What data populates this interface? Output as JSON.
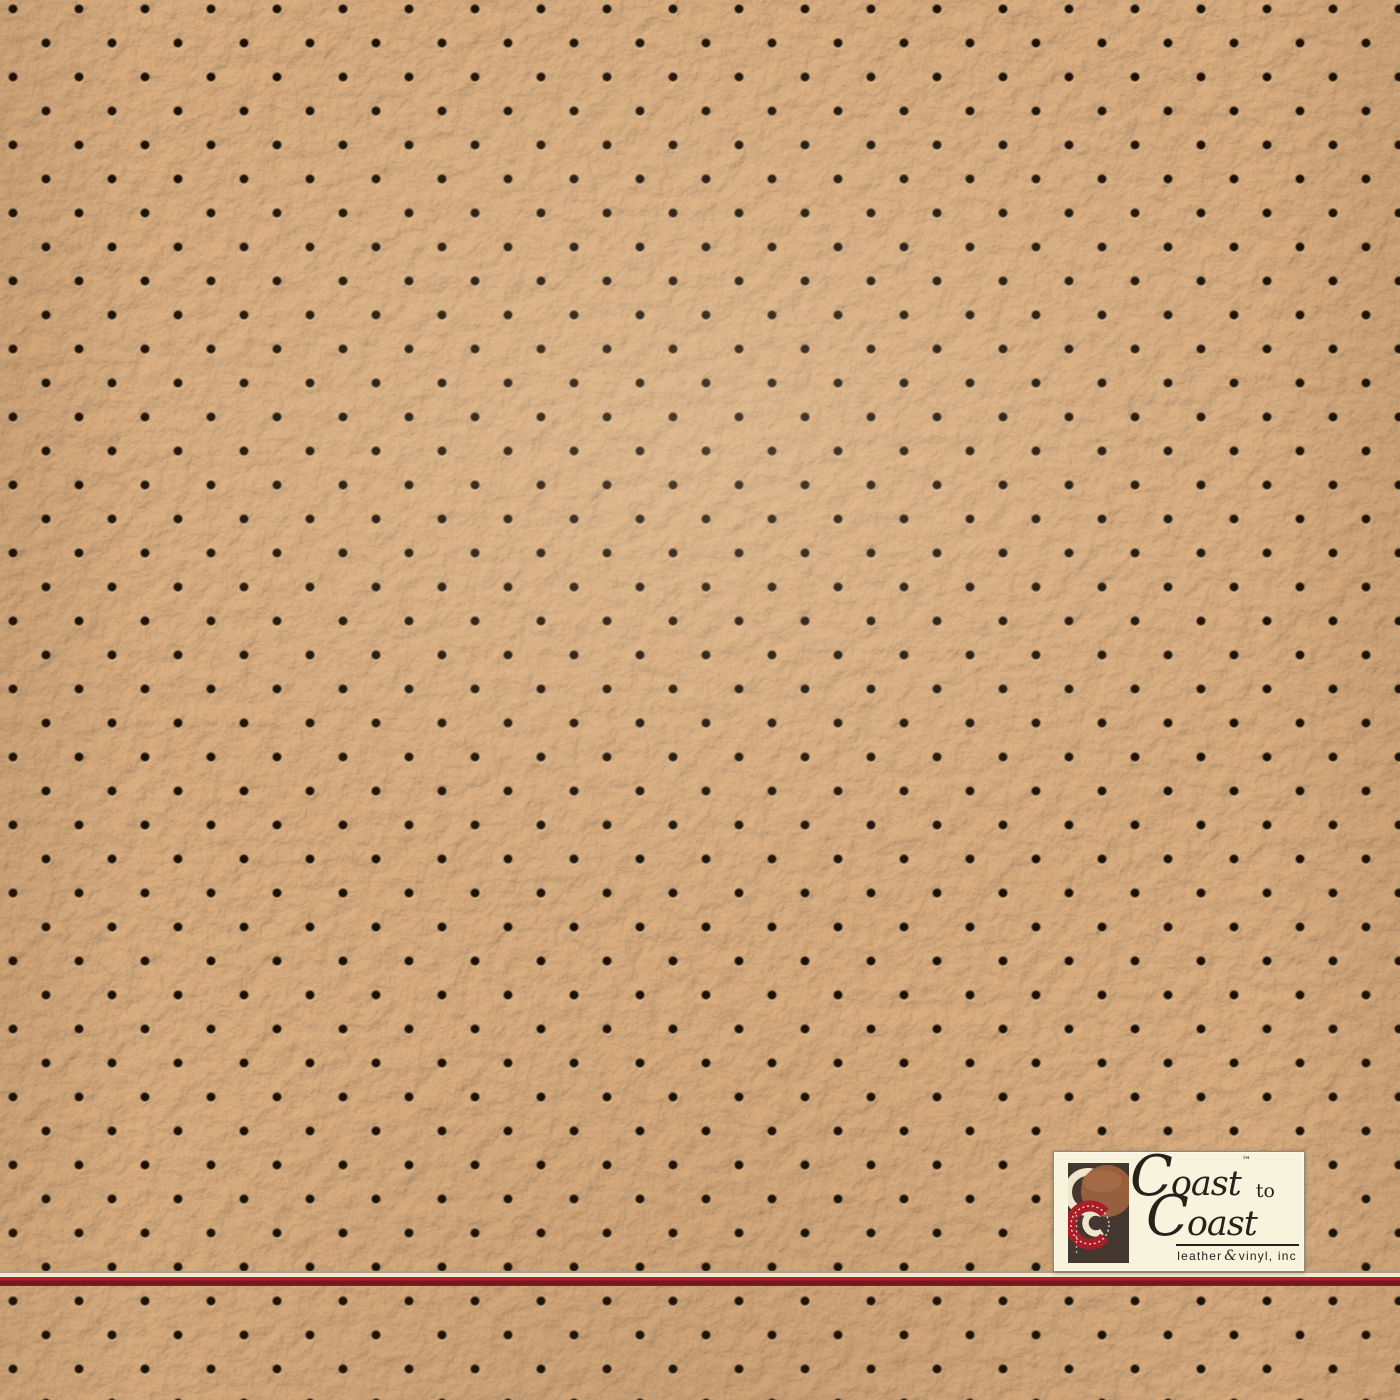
{
  "canvas": {
    "width_px": 1400,
    "height_px": 1400
  },
  "photo": {
    "subject": "Perforated pebble-grain tan leather vinyl upholstery swatch",
    "perforation_grid": {
      "pitch_x_px": 66,
      "pitch_y_px": 34,
      "stagger": "alternate rows offset by half pitch",
      "hole_diameter_px": 9
    }
  },
  "colors": {
    "leather-base": "#cfa173",
    "leather-highlight": "#e0b486",
    "perforation-core": "#1b1106",
    "stripe-cream": "#f2e9d0",
    "stripe-red-top": "#b22127",
    "stripe-red-bottom": "#6e1d1f",
    "logo-bg": "#f8f3dd",
    "logo-text": "#27211a",
    "logo-mark-dark": "#443730",
    "logo-mark-sienna": "#96603f",
    "logo-mark-red": "#a81e28",
    "logo-mark-cream": "#eee5cb"
  },
  "logo": {
    "coast1": {
      "cap": "C",
      "rest": "oast"
    },
    "trademark": "™",
    "to": "to",
    "coast2": {
      "cap": "C",
      "rest": "oast"
    },
    "tagline": {
      "word1": "leather",
      "amp": "&",
      "word2": "vinyl, inc"
    }
  }
}
